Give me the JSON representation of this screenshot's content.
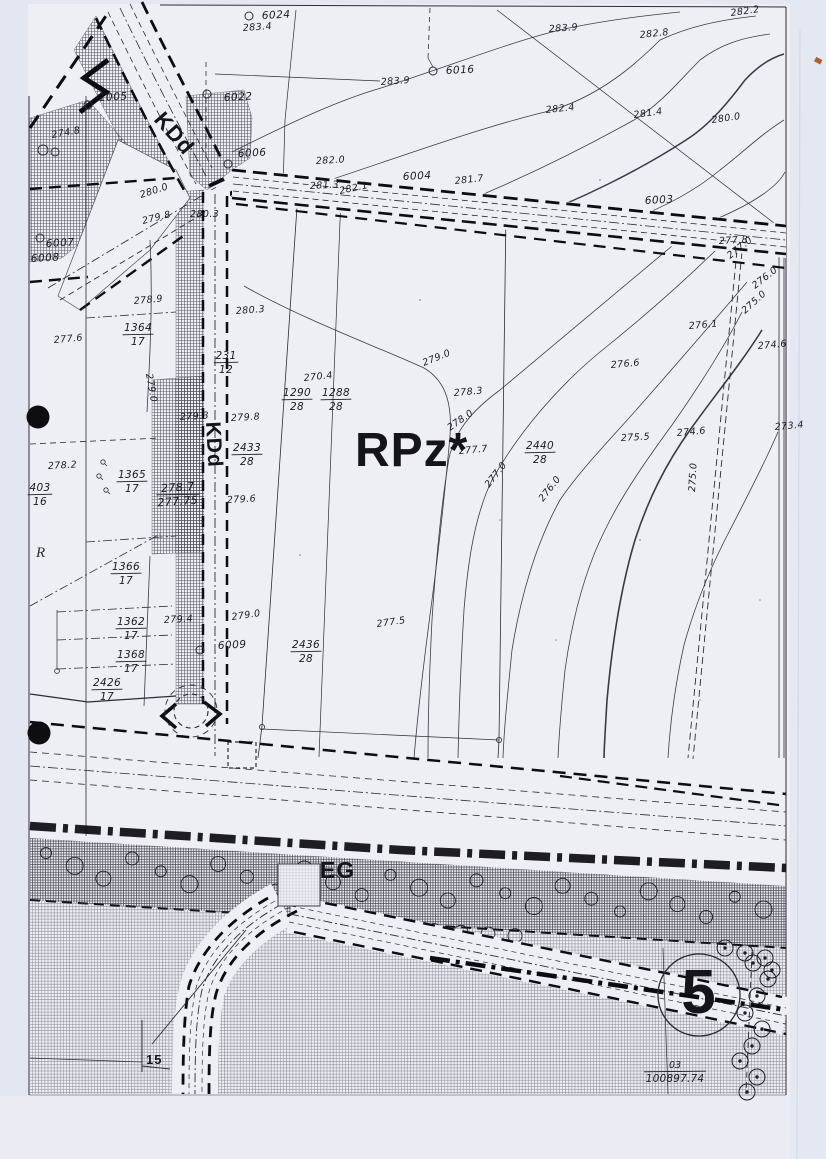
{
  "page": {
    "title": "Scanned cadastral zoning plan sheet"
  },
  "map": {
    "zone_labels": [
      {
        "text": "RPz*",
        "x": 355,
        "y": 466,
        "size": 48,
        "rot": 0,
        "name": "zone-label-rpz"
      },
      {
        "text": "KDd",
        "x": 153,
        "y": 120,
        "size": 22,
        "rot": 49,
        "name": "road-label-kdd-diagonal"
      },
      {
        "text": "KDd",
        "x": 206,
        "y": 422,
        "size": 21,
        "rot": 87,
        "name": "road-label-kdd-vertical"
      },
      {
        "text": "EG",
        "x": 320,
        "y": 878,
        "size": 23,
        "rot": 0,
        "name": "zone-label-eg"
      },
      {
        "text": "R",
        "x": 36,
        "y": 557,
        "size": 15,
        "rot": 0,
        "italic": true,
        "name": "zone-label-r"
      },
      {
        "text": "5",
        "x": 699,
        "y": 1013,
        "size": 62,
        "rot": 0,
        "anchor": "middle",
        "name": "sheet-number-5"
      },
      {
        "text": "15",
        "x": 146,
        "y": 1064,
        "size": 13,
        "rot": 0,
        "name": "label-15"
      }
    ],
    "survey_points": [
      {
        "id": "6024",
        "tx": 262,
        "ty": 19,
        "cx": 249,
        "cy": 16
      },
      {
        "id": "6016",
        "tx": 446,
        "ty": 74,
        "cx": 433,
        "cy": 71
      },
      {
        "id": "6022",
        "tx": 224,
        "ty": 101,
        "cx": 207,
        "cy": 94
      },
      {
        "id": "1005",
        "tx": 99,
        "ty": 101,
        "cx": 88,
        "cy": 105
      },
      {
        "id": "6006",
        "tx": 238,
        "ty": 157,
        "cx": 228,
        "cy": 164
      },
      {
        "id": "6004",
        "tx": 403,
        "ty": 180
      },
      {
        "id": "6003",
        "tx": 645,
        "ty": 204
      },
      {
        "id": "6007",
        "tx": 46,
        "ty": 247,
        "cx": 40,
        "cy": 238
      },
      {
        "id": "6008",
        "tx": 31,
        "ty": 262
      },
      {
        "id": "6009",
        "tx": 218,
        "ty": 649,
        "cx": 200,
        "cy": 650
      }
    ],
    "elevation_labels": [
      {
        "text": "283.4",
        "x": 243,
        "y": 31,
        "rot": -4
      },
      {
        "text": "283.9",
        "x": 549,
        "y": 32,
        "rot": -4
      },
      {
        "text": "282.8",
        "x": 640,
        "y": 38,
        "rot": -6
      },
      {
        "text": "282.2",
        "x": 731,
        "y": 16,
        "rot": -8
      },
      {
        "text": "283.9",
        "x": 381,
        "y": 85,
        "rot": -4
      },
      {
        "text": "282.4",
        "x": 546,
        "y": 113,
        "rot": -6
      },
      {
        "text": "281.4",
        "x": 634,
        "y": 118,
        "rot": -8
      },
      {
        "text": "280.0",
        "x": 712,
        "y": 123,
        "rot": -8
      },
      {
        "text": "282.0",
        "x": 316,
        "y": 164,
        "rot": -3
      },
      {
        "text": "281.3",
        "x": 310,
        "y": 189,
        "rot": -3
      },
      {
        "text": "282.1",
        "x": 340,
        "y": 194,
        "rot": -12
      },
      {
        "text": "281.7",
        "x": 455,
        "y": 184,
        "rot": -6
      },
      {
        "text": "280.3",
        "x": 190,
        "y": 217,
        "rot": 0
      },
      {
        "text": "280.0",
        "x": 141,
        "y": 198,
        "rot": -18
      },
      {
        "text": "279.8",
        "x": 143,
        "y": 224,
        "rot": -14
      },
      {
        "text": "278.9",
        "x": 134,
        "y": 304,
        "rot": -5
      },
      {
        "text": "279.0",
        "x": 146,
        "y": 374,
        "rot": 80
      },
      {
        "text": "277.6",
        "x": 54,
        "y": 343,
        "rot": -5
      },
      {
        "text": "278.2",
        "x": 48,
        "y": 469,
        "rot": -3
      },
      {
        "text": "280.3",
        "x": 236,
        "y": 314,
        "rot": -4
      },
      {
        "text": "279.3",
        "x": 180,
        "y": 420,
        "rot": -3
      },
      {
        "text": "279.8",
        "x": 231,
        "y": 421,
        "rot": -3
      },
      {
        "text": "279.6",
        "x": 227,
        "y": 503,
        "rot": -3
      },
      {
        "text": "279.4",
        "x": 164,
        "y": 623,
        "rot": -3
      },
      {
        "text": "279.0",
        "x": 232,
        "y": 620,
        "rot": -8
      },
      {
        "text": "277.5",
        "x": 377,
        "y": 627,
        "rot": -8
      },
      {
        "text": "270.4",
        "x": 304,
        "y": 381,
        "rot": -6
      },
      {
        "text": "279.0",
        "x": 424,
        "y": 366,
        "rot": -22
      },
      {
        "text": "278.3",
        "x": 454,
        "y": 396,
        "rot": -5
      },
      {
        "text": "278.0",
        "x": 450,
        "y": 431,
        "rot": -35
      },
      {
        "text": "277.7",
        "x": 459,
        "y": 454,
        "rot": -5
      },
      {
        "text": "277.0",
        "x": 489,
        "y": 488,
        "rot": -52
      },
      {
        "text": "276.0",
        "x": 543,
        "y": 502,
        "rot": -52
      },
      {
        "text": "276.6",
        "x": 611,
        "y": 368,
        "rot": -5
      },
      {
        "text": "276.1",
        "x": 689,
        "y": 329,
        "rot": -5
      },
      {
        "text": "275.5",
        "x": 621,
        "y": 441,
        "rot": -3
      },
      {
        "text": "274.6",
        "x": 677,
        "y": 436,
        "rot": -5
      },
      {
        "text": "274.6",
        "x": 758,
        "y": 349,
        "rot": -5
      },
      {
        "text": "273.4",
        "x": 775,
        "y": 430,
        "rot": -5
      },
      {
        "text": "277.8",
        "x": 719,
        "y": 244,
        "rot": -3
      },
      {
        "text": "277.0",
        "x": 730,
        "y": 259,
        "rot": -38
      },
      {
        "text": "276.0",
        "x": 755,
        "y": 289,
        "rot": -38
      },
      {
        "text": "275.0",
        "x": 745,
        "y": 314,
        "rot": -42
      },
      {
        "text": "275.0",
        "x": 695,
        "y": 492,
        "rot": -87
      },
      {
        "text": "274.8",
        "x": 52,
        "y": 138,
        "rot": -10
      }
    ],
    "parcel_labels": [
      {
        "numerator": "1364",
        "denominator": "17",
        "x": 138,
        "y": 331
      },
      {
        "numerator": "231",
        "denominator": "12",
        "x": 226,
        "y": 359
      },
      {
        "numerator": "2433",
        "denominator": "28",
        "x": 247,
        "y": 451
      },
      {
        "numerator": "1290",
        "denominator": "28",
        "x": 297,
        "y": 396
      },
      {
        "numerator": "1288",
        "denominator": "28",
        "x": 336,
        "y": 396
      },
      {
        "numerator": "2440",
        "denominator": "28",
        "x": 540,
        "y": 449
      },
      {
        "numerator": "1365",
        "denominator": "17",
        "x": 132,
        "y": 478
      },
      {
        "numerator": "1366",
        "denominator": "17",
        "x": 126,
        "y": 570
      },
      {
        "numerator": "1362",
        "denominator": "17",
        "x": 131,
        "y": 625
      },
      {
        "numerator": "1368",
        "denominator": "17",
        "x": 131,
        "y": 658
      },
      {
        "numerator": "2426",
        "denominator": "17",
        "x": 107,
        "y": 686
      },
      {
        "numerator": "403",
        "denominator": "16",
        "x": 40,
        "y": 491
      },
      {
        "numerator": "2436",
        "denominator": "28",
        "x": 306,
        "y": 648
      },
      {
        "numerator": "278.7",
        "denominator": "277.75",
        "x": 178,
        "y": 491,
        "style": "hand"
      },
      {
        "numerator": "03",
        "denominator": "100897.74",
        "x": 675,
        "y": 1068,
        "style": "ref"
      }
    ]
  }
}
